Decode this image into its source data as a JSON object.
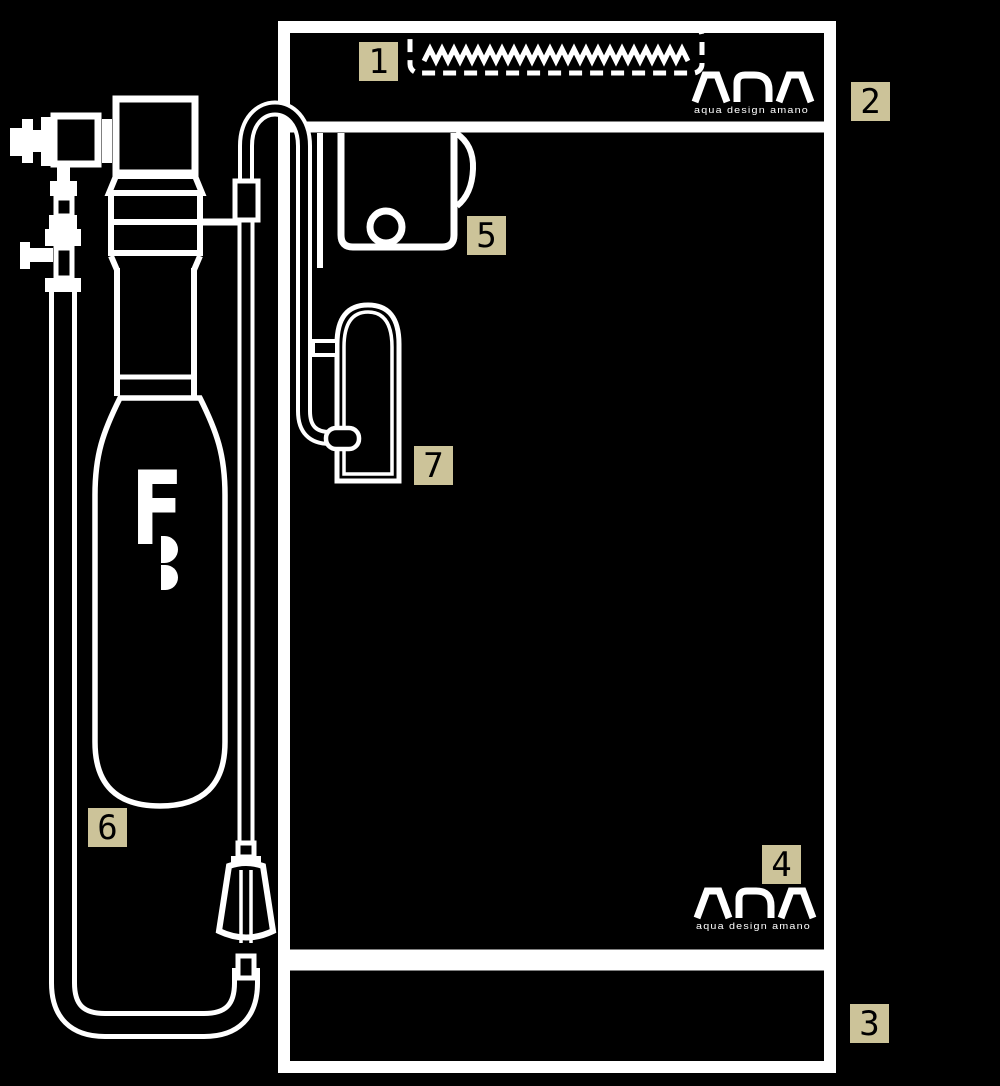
{
  "brand": {
    "name": "ADA",
    "subtext": "aqua design amano"
  },
  "bottle": {
    "mark": "F"
  },
  "callouts": [
    {
      "number": "1"
    },
    {
      "number": "2"
    },
    {
      "number": "3"
    },
    {
      "number": "4"
    },
    {
      "number": "5"
    },
    {
      "number": "6"
    },
    {
      "number": "7"
    }
  ],
  "colors": {
    "background": "#000000",
    "line": "#ffffff",
    "callout_bg": "#ccc399",
    "callout_text": "#000000"
  }
}
